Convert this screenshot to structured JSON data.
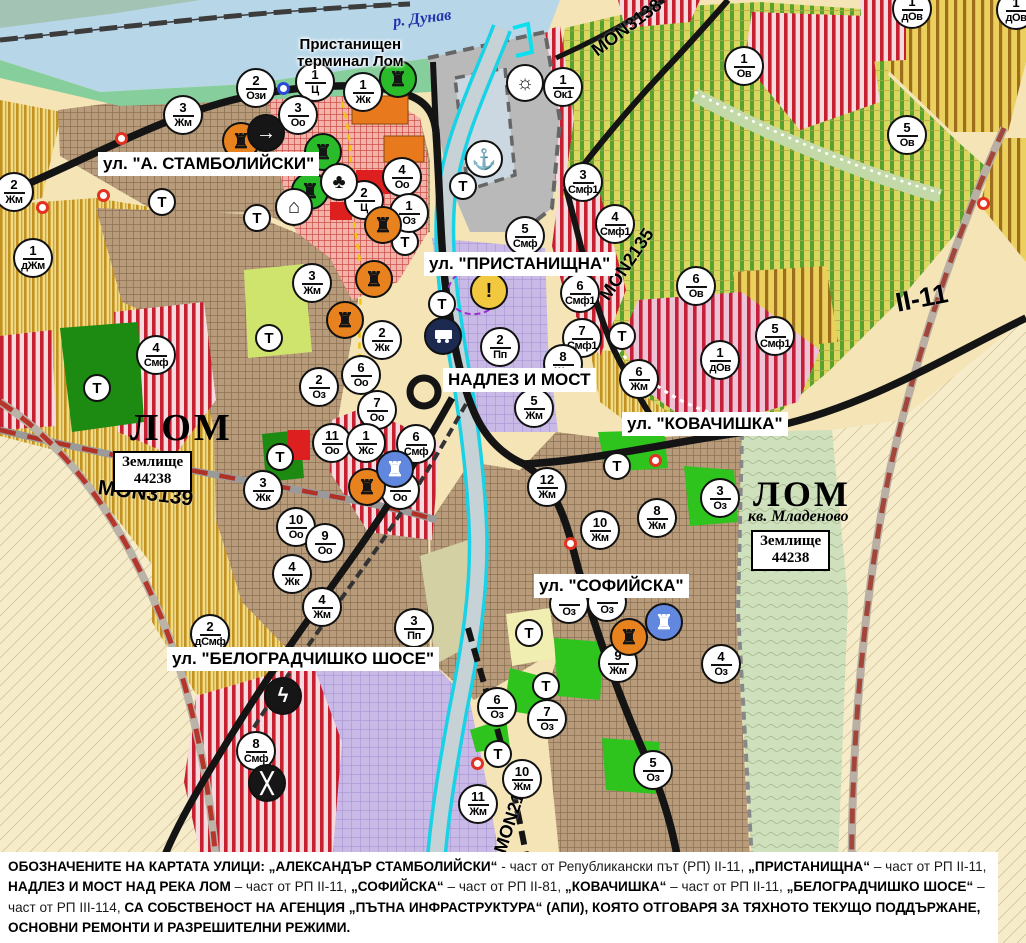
{
  "map_title": "кадастрална/устройствена карта на гр. Лом",
  "colors": {
    "water": "#b7d7e9",
    "shore_green": "#86cf9c",
    "port_gray": "#b9b9b9",
    "urban_brown": "#b79b7b",
    "center_pink": "#f2b3ab",
    "production_purple": "#c9b9e7",
    "smf_red_stripe": "#c51f30",
    "park_green": "#2fc31d",
    "forest_green": "#1d8a12",
    "vineyard_gold": "#f3da7a",
    "ov_green_stripe": "#5aa22e",
    "dov_brown_stripe": "#9c6d1a",
    "road_black": "#141414",
    "repair_road_red": "#b5372b",
    "contour_green": "#cfe0bd",
    "river_cyan": "#1ad2e6",
    "marker_orange": "#e8821e",
    "marker_green": "#2abb2a",
    "marker_blue": "#6287de",
    "warning_yellow": "#f2c83e"
  },
  "t_symbol": "Т",
  "labels": [
    {
      "kind": "street",
      "text": "ул. \"А. СТАМБОЛИЙСКИ\"",
      "x": 98,
      "y": 152
    },
    {
      "kind": "street",
      "text": "ул. \"ПРИСТАНИЩНА\"",
      "x": 424,
      "y": 252
    },
    {
      "kind": "street",
      "text": "НАДЛЕЗ И МОСТ",
      "x": 443,
      "y": 368
    },
    {
      "kind": "street",
      "text": "ул. \"КОВАЧИШКА\"",
      "x": 622,
      "y": 412
    },
    {
      "kind": "street",
      "text": "ул. \"СОФИЙСКА\"",
      "x": 534,
      "y": 574
    },
    {
      "kind": "street",
      "text": "ул. \"БЕЛОГРАДЧИШКО ШОСЕ\"",
      "x": 167,
      "y": 647
    },
    {
      "kind": "terminal",
      "text": "Пристанищен\nтерминал Лом",
      "x": 297,
      "y": 36
    },
    {
      "kind": "river",
      "text": "р. Дунав",
      "x": 393,
      "y": 10
    },
    {
      "kind": "lom",
      "text": "ЛОМ",
      "x": 130,
      "y": 406
    },
    {
      "kind": "zbox",
      "text": "Землище\n44238",
      "x": 113,
      "y": 451
    },
    {
      "kind": "road",
      "text": "MON3139",
      "x": 98,
      "y": 476,
      "rot": 7,
      "size": 21
    },
    {
      "kind": "lom",
      "text": "ЛОМ",
      "x": 753,
      "y": 473,
      "size": 36
    },
    {
      "kind": "lomsub",
      "text": "кв. Младеново",
      "x": 748,
      "y": 508
    },
    {
      "kind": "zbox",
      "text": "Землище\n44238",
      "x": 751,
      "y": 530
    },
    {
      "kind": "road",
      "text": "MON3138",
      "x": 594,
      "y": 42,
      "rot": -37,
      "size": 18
    },
    {
      "kind": "road",
      "text": "MON2135",
      "x": 604,
      "y": 288,
      "rot": -56,
      "size": 18
    },
    {
      "kind": "road",
      "text": "II-11",
      "x": 896,
      "y": 288,
      "rot": -11,
      "size": 27
    },
    {
      "kind": "road",
      "text": "MON2136",
      "x": 500,
      "y": 842,
      "rot": -72,
      "size": 18
    }
  ],
  "markers": {
    "zones": [
      {
        "x": 256,
        "y": 88,
        "n": "2",
        "code": "Ози"
      },
      {
        "x": 315,
        "y": 82,
        "n": "1",
        "code": "Ц"
      },
      {
        "x": 363,
        "y": 92,
        "n": "1",
        "code": "Жк"
      },
      {
        "x": 298,
        "y": 115,
        "n": "3",
        "code": "Оо"
      },
      {
        "x": 183,
        "y": 115,
        "n": "3",
        "code": "Жм"
      },
      {
        "x": 14,
        "y": 192,
        "n": "2",
        "code": "Жм"
      },
      {
        "x": 33,
        "y": 258,
        "n": "1",
        "code": "дЖм"
      },
      {
        "x": 563,
        "y": 87,
        "n": "1",
        "code": "Ок1"
      },
      {
        "x": 744,
        "y": 66,
        "n": "1",
        "code": "Ов"
      },
      {
        "x": 907,
        "y": 135,
        "n": "5",
        "code": "Ов"
      },
      {
        "x": 912,
        "y": 9,
        "n": "1",
        "code": "дОв"
      },
      {
        "x": 1016,
        "y": 10,
        "n": "1",
        "code": "дОв"
      },
      {
        "x": 402,
        "y": 177,
        "n": "4",
        "code": "Оо"
      },
      {
        "x": 364,
        "y": 200,
        "n": "2",
        "code": "Ц"
      },
      {
        "x": 409,
        "y": 213,
        "n": "1",
        "code": "Оз"
      },
      {
        "x": 312,
        "y": 283,
        "n": "3",
        "code": "Жм"
      },
      {
        "x": 525,
        "y": 236,
        "n": "5",
        "code": "Смф"
      },
      {
        "x": 583,
        "y": 182,
        "n": "3",
        "code": "Смф1"
      },
      {
        "x": 615,
        "y": 224,
        "n": "4",
        "code": "Смф1"
      },
      {
        "x": 580,
        "y": 293,
        "n": "6",
        "code": "Смф1"
      },
      {
        "x": 582,
        "y": 338,
        "n": "7",
        "code": "Смф1"
      },
      {
        "x": 696,
        "y": 286,
        "n": "6",
        "code": "Ов"
      },
      {
        "x": 720,
        "y": 360,
        "n": "1",
        "code": "дОв"
      },
      {
        "x": 775,
        "y": 336,
        "n": "5",
        "code": "Смф1"
      },
      {
        "x": 382,
        "y": 340,
        "n": "2",
        "code": "Жк"
      },
      {
        "x": 319,
        "y": 387,
        "n": "2",
        "code": "Оз"
      },
      {
        "x": 361,
        "y": 375,
        "n": "6",
        "code": "Оо"
      },
      {
        "x": 377,
        "y": 410,
        "n": "7",
        "code": "Оо"
      },
      {
        "x": 332,
        "y": 443,
        "n": "11",
        "code": "Оо"
      },
      {
        "x": 366,
        "y": 443,
        "n": "1",
        "code": "Жс"
      },
      {
        "x": 416,
        "y": 444,
        "n": "6",
        "code": "Смф"
      },
      {
        "x": 400,
        "y": 490,
        "n": "8",
        "code": "Оо"
      },
      {
        "x": 296,
        "y": 527,
        "n": "10",
        "code": "Оо"
      },
      {
        "x": 325,
        "y": 543,
        "n": "9",
        "code": "Оо"
      },
      {
        "x": 292,
        "y": 574,
        "n": "4",
        "code": "Жк"
      },
      {
        "x": 322,
        "y": 607,
        "n": "4",
        "code": "Жм"
      },
      {
        "x": 263,
        "y": 490,
        "n": "3",
        "code": "Жк"
      },
      {
        "x": 156,
        "y": 355,
        "n": "4",
        "code": "Смф"
      },
      {
        "x": 210,
        "y": 634,
        "n": "2",
        "code": "дСмф"
      },
      {
        "x": 414,
        "y": 628,
        "n": "3",
        "code": "Пп"
      },
      {
        "x": 256,
        "y": 751,
        "n": "8",
        "code": "Смф"
      },
      {
        "x": 500,
        "y": 347,
        "n": "2",
        "code": "Пп"
      },
      {
        "x": 534,
        "y": 408,
        "n": "5",
        "code": "Жм"
      },
      {
        "x": 563,
        "y": 364,
        "n": "8",
        "code": "Жм"
      },
      {
        "x": 639,
        "y": 379,
        "n": "6",
        "code": "Жм"
      },
      {
        "x": 547,
        "y": 487,
        "n": "12",
        "code": "Жм"
      },
      {
        "x": 600,
        "y": 530,
        "n": "10",
        "code": "Жм"
      },
      {
        "x": 657,
        "y": 518,
        "n": "8",
        "code": "Жм"
      },
      {
        "x": 720,
        "y": 498,
        "n": "3",
        "code": "Оз"
      },
      {
        "x": 618,
        "y": 663,
        "n": "9",
        "code": "Жм"
      },
      {
        "x": 721,
        "y": 664,
        "n": "4",
        "code": "Оз"
      },
      {
        "x": 497,
        "y": 707,
        "n": "6",
        "code": "Оз"
      },
      {
        "x": 547,
        "y": 719,
        "n": "7",
        "code": "Оз"
      },
      {
        "x": 522,
        "y": 779,
        "n": "10",
        "code": "Жм"
      },
      {
        "x": 478,
        "y": 804,
        "n": "11",
        "code": "Жм"
      },
      {
        "x": 653,
        "y": 770,
        "n": "5",
        "code": "Оз"
      },
      {
        "x": 569,
        "y": 604,
        "n": "",
        "code": "Оз"
      },
      {
        "x": 607,
        "y": 602,
        "n": "",
        "code": "Оз"
      }
    ],
    "transport": [
      {
        "x": 162,
        "y": 202
      },
      {
        "x": 257,
        "y": 218
      },
      {
        "x": 269,
        "y": 338
      },
      {
        "x": 97,
        "y": 388
      },
      {
        "x": 280,
        "y": 457
      },
      {
        "x": 463,
        "y": 186
      },
      {
        "x": 405,
        "y": 242
      },
      {
        "x": 442,
        "y": 304
      },
      {
        "x": 622,
        "y": 336
      },
      {
        "x": 617,
        "y": 466
      },
      {
        "x": 529,
        "y": 633
      },
      {
        "x": 546,
        "y": 686
      },
      {
        "x": 498,
        "y": 754
      }
    ],
    "icons": [
      {
        "x": 241,
        "y": 141,
        "name": "monument-icon",
        "color": "orange",
        "glyph": "masks"
      },
      {
        "x": 383,
        "y": 225,
        "name": "monument-icon",
        "color": "orange",
        "glyph": "masks"
      },
      {
        "x": 374,
        "y": 279,
        "name": "monument-icon",
        "color": "orange",
        "glyph": "masks"
      },
      {
        "x": 345,
        "y": 320,
        "name": "monument-icon",
        "color": "orange",
        "glyph": "masks"
      },
      {
        "x": 367,
        "y": 487,
        "name": "monument-icon",
        "color": "orange",
        "glyph": "masks"
      },
      {
        "x": 629,
        "y": 637,
        "name": "monument-icon",
        "color": "orange",
        "glyph": "masks"
      },
      {
        "x": 323,
        "y": 152,
        "name": "monument-icon",
        "color": "green",
        "glyph": "masks"
      },
      {
        "x": 310,
        "y": 191,
        "name": "monument-icon",
        "color": "green",
        "glyph": "masks"
      },
      {
        "x": 398,
        "y": 79,
        "name": "monument-icon",
        "color": "green",
        "glyph": "masks"
      },
      {
        "x": 395,
        "y": 469,
        "name": "monument-icon",
        "color": "blue",
        "glyph": "masks"
      },
      {
        "x": 664,
        "y": 622,
        "name": "monument-icon",
        "color": "blue",
        "glyph": "masks"
      },
      {
        "x": 266,
        "y": 133,
        "name": "direction-arrow-icon",
        "color": "black",
        "glyph": "arrow"
      },
      {
        "x": 339,
        "y": 182,
        "name": "clover-icon",
        "color": "white",
        "glyph": "clover"
      },
      {
        "x": 294,
        "y": 207,
        "name": "shelter-icon",
        "color": "white",
        "glyph": "house"
      },
      {
        "x": 484,
        "y": 159,
        "name": "anchor-port-icon",
        "color": "white",
        "glyph": "anchor"
      },
      {
        "x": 525,
        "y": 83,
        "name": "sun-icon",
        "color": "white",
        "glyph": "sun"
      },
      {
        "x": 443,
        "y": 336,
        "name": "truck-terminal-icon",
        "color": "navy",
        "glyph": "truck"
      },
      {
        "x": 489,
        "y": 291,
        "name": "warning-icon",
        "color": "yellow",
        "glyph": "warn"
      },
      {
        "x": 283,
        "y": 696,
        "name": "power-station-icon",
        "color": "black",
        "glyph": "bolt"
      },
      {
        "x": 267,
        "y": 783,
        "name": "rail-crossing-icon",
        "color": "black",
        "glyph": "cross"
      }
    ],
    "dots": [
      {
        "x": 121,
        "y": 138,
        "color": "red"
      },
      {
        "x": 103,
        "y": 195,
        "color": "red"
      },
      {
        "x": 42,
        "y": 207,
        "color": "red"
      },
      {
        "x": 655,
        "y": 460,
        "color": "red"
      },
      {
        "x": 570,
        "y": 543,
        "color": "red"
      },
      {
        "x": 983,
        "y": 203,
        "color": "red"
      },
      {
        "x": 477,
        "y": 763,
        "color": "red"
      },
      {
        "x": 283,
        "y": 88,
        "color": "blue"
      }
    ]
  },
  "note": {
    "segments": [
      {
        "b": 1,
        "t": "ОБОЗНАЧЕНИТЕ НА КАРТАТА УЛИЦИ: „АЛЕКСАНДЪР СТАМБОЛИЙСКИ“"
      },
      {
        "b": 0,
        "t": " - част от Републикански път (РП) II-11, "
      },
      {
        "b": 1,
        "t": "„ПРИСТАНИЩНА“"
      },
      {
        "b": 0,
        "t": " – част от РП II-11, "
      },
      {
        "b": 1,
        "t": "НАДЛЕЗ И МОСТ НАД РЕКА ЛОМ"
      },
      {
        "b": 0,
        "t": " – част от РП II-11, "
      },
      {
        "b": 1,
        "t": "„СОФИЙСКА“"
      },
      {
        "b": 0,
        "t": " – част от РП II-81, "
      },
      {
        "b": 1,
        "t": "„КОВАЧИШКА“"
      },
      {
        "b": 0,
        "t": " – част от РП II-11, "
      },
      {
        "b": 1,
        "t": "„БЕЛОГРАДЧИШКО ШОСЕ“"
      },
      {
        "b": 0,
        "t": " – част от РП III-114, "
      },
      {
        "b": 1,
        "t": "СА СОБСТВЕНОСТ НА АГЕНЦИЯ „ПЪТНА ИНФРАСТРУКТУРА“ (АПИ), КОЯТО ОТГОВАРЯ ЗА ТЯХНОТО ТЕКУЩО ПОДДЪРЖАНЕ, ОСНОВНИ РЕМОНТИ И РАЗРЕШИТЕЛНИ РЕЖИМИ."
      }
    ]
  }
}
